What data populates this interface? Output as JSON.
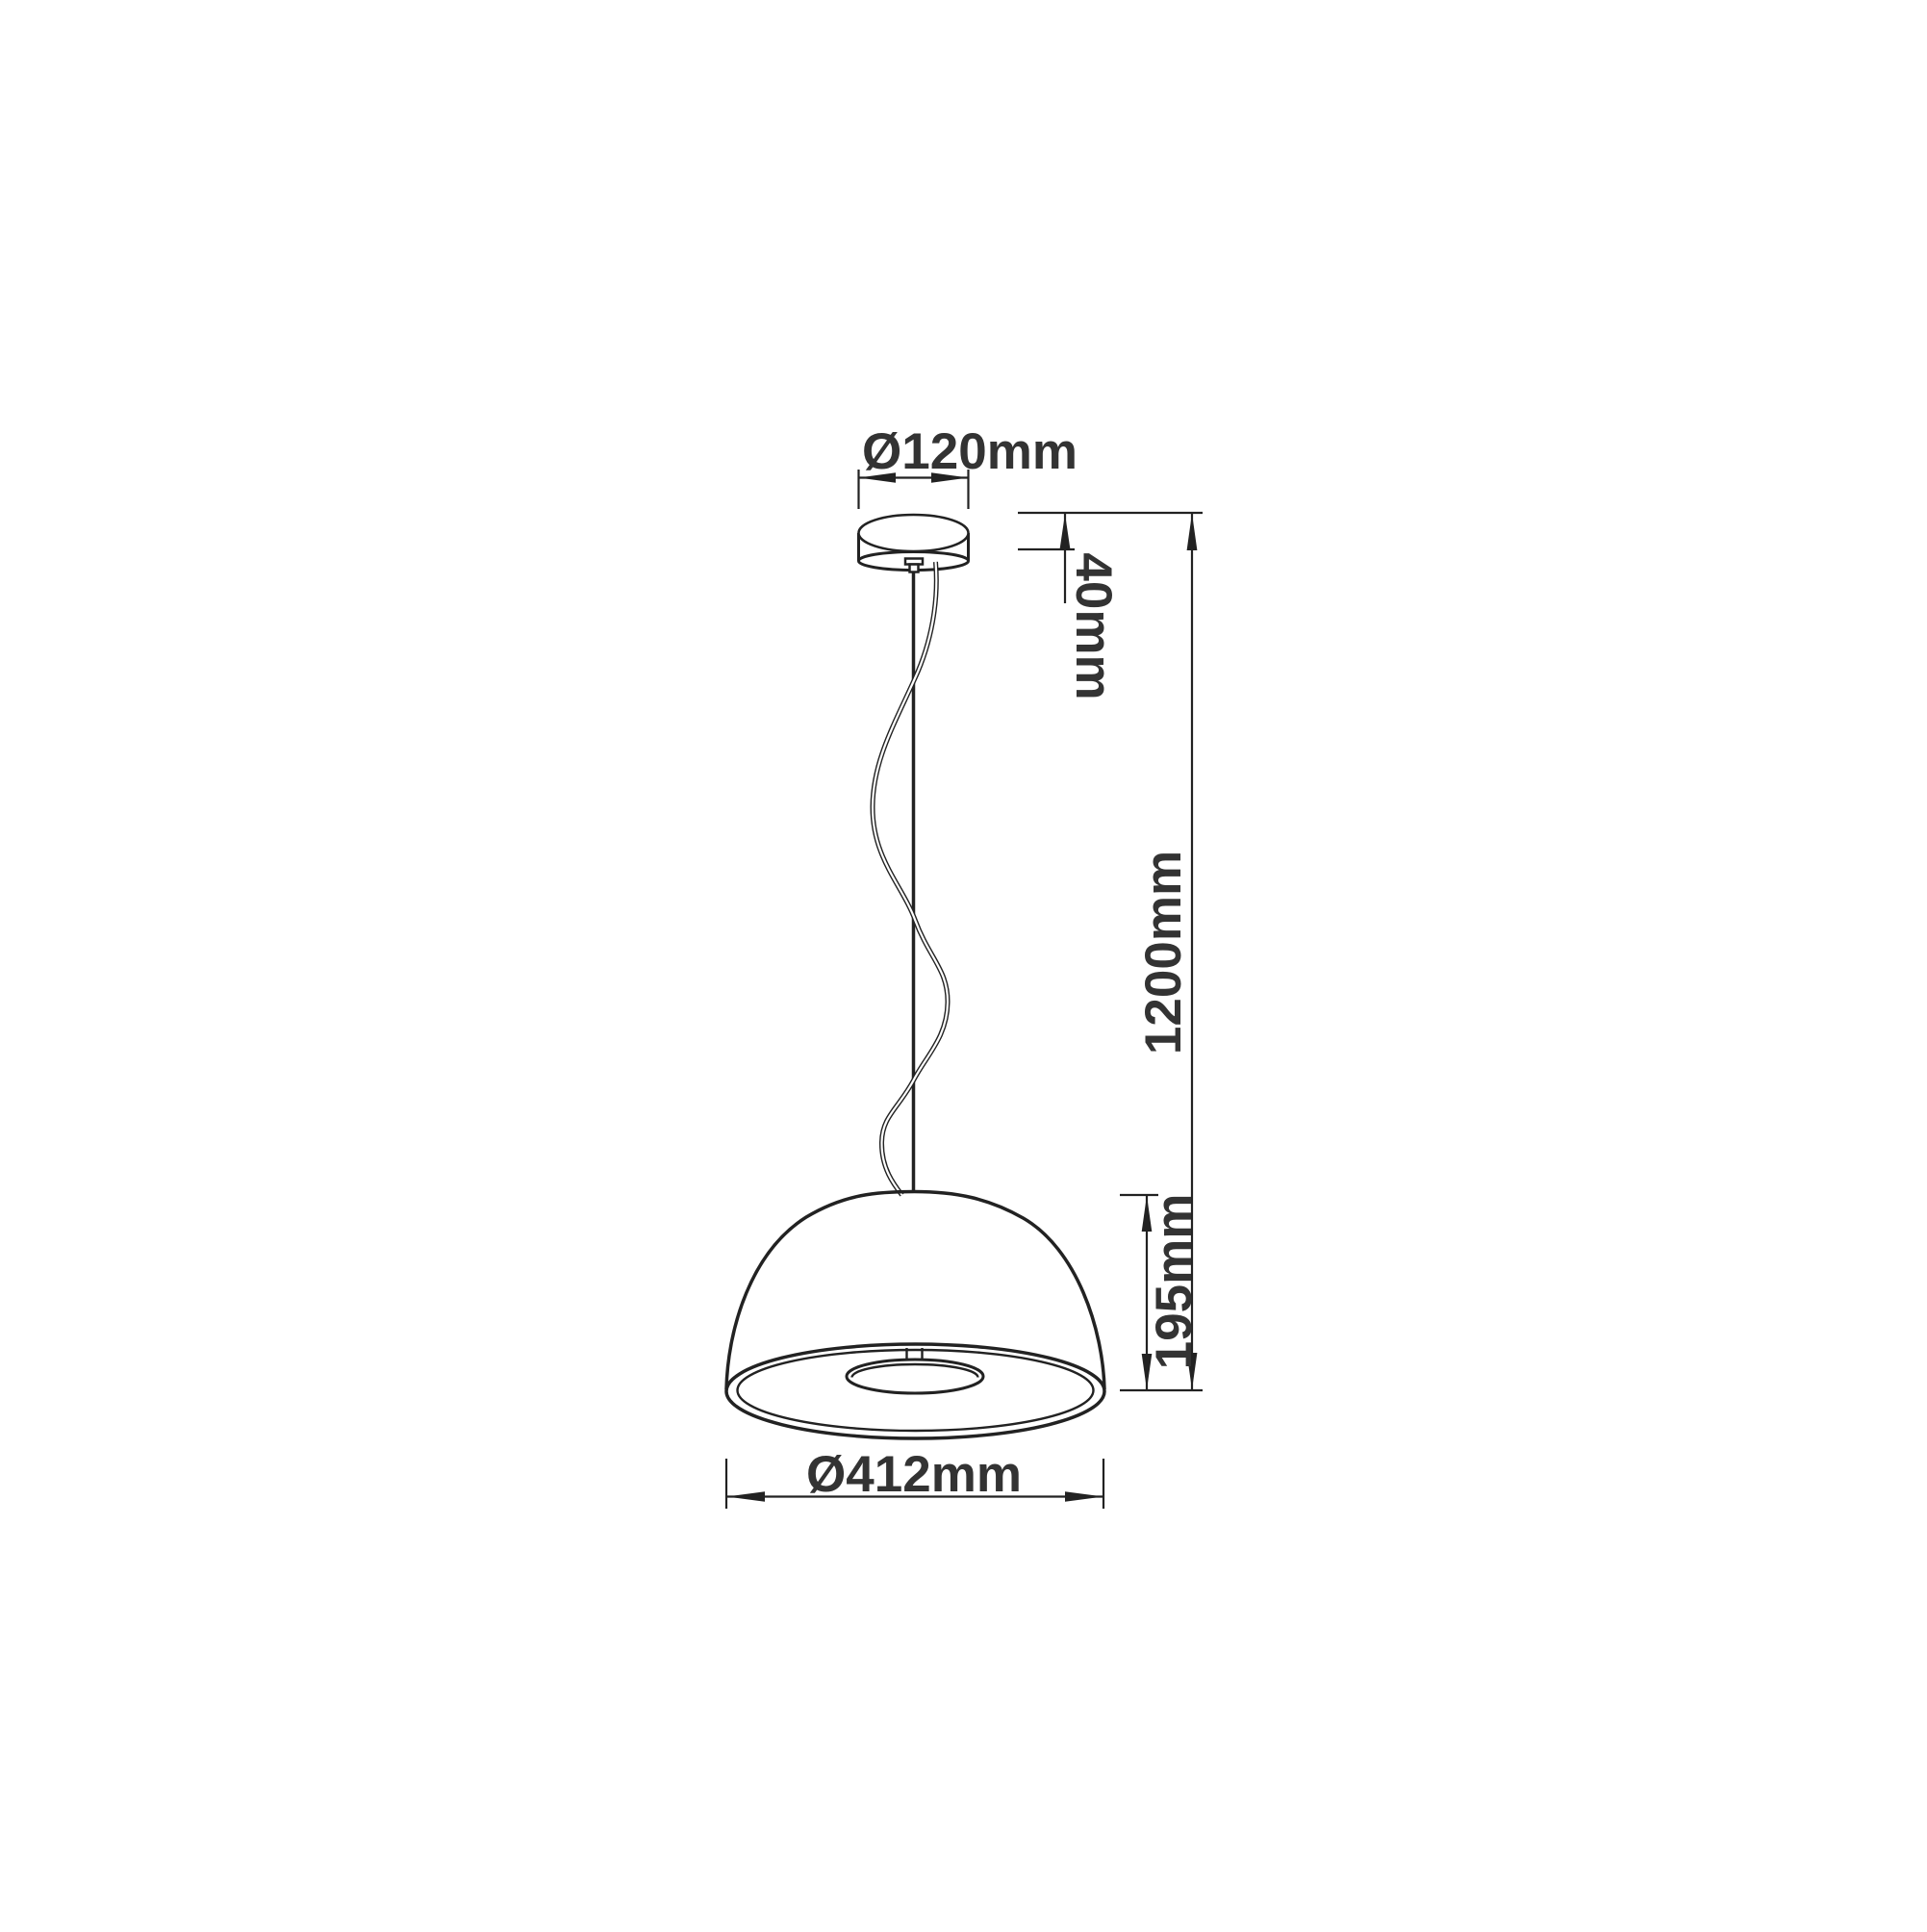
{
  "drawing": {
    "kind": "pendant-lamp-dimension-diagram",
    "labels": {
      "canopy_diameter": "Ø120mm",
      "canopy_height": "40mm",
      "suspension_length": "1200mm",
      "shade_height": "195mm",
      "shade_diameter": "Ø412mm"
    },
    "colors": {
      "line": "#222222",
      "text": "#333333",
      "background": "#ffffff"
    }
  }
}
